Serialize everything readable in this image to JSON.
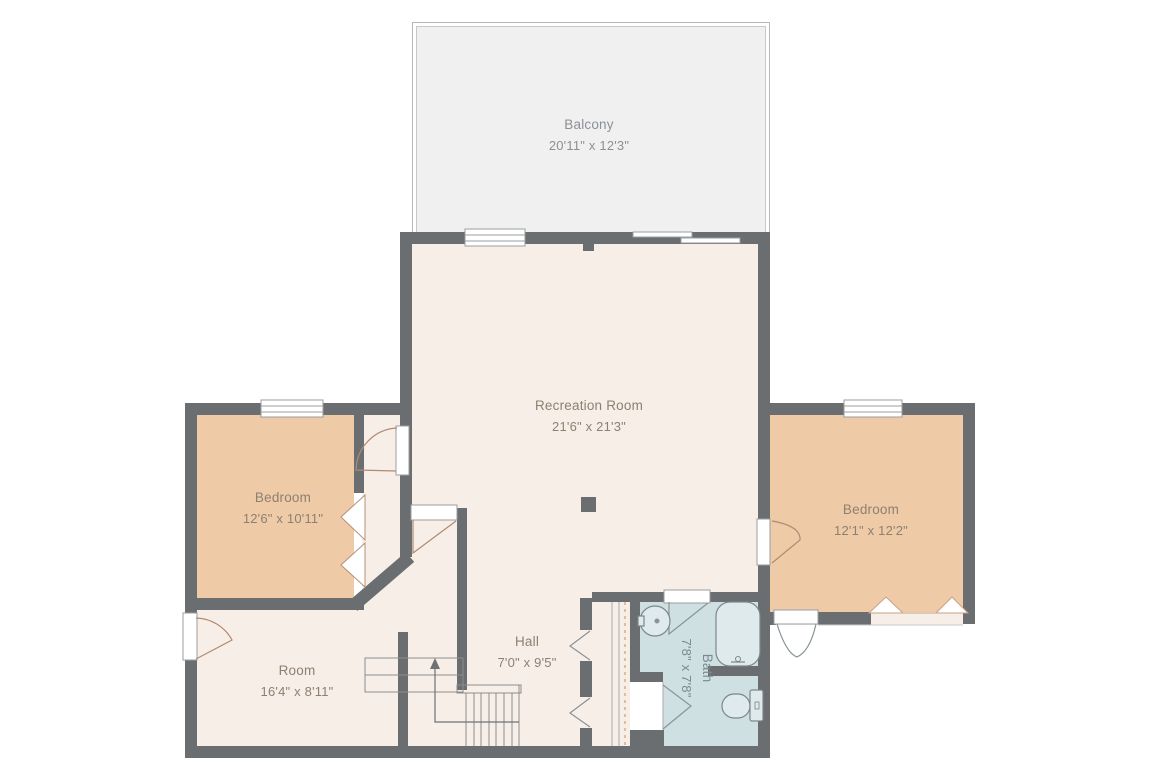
{
  "title": "Floor plan",
  "rooms": [
    {
      "name": "Balcony",
      "dims": "20'11\" x 12'3\""
    },
    {
      "name": "Recreation Room",
      "dims": "21'6\" x 21'3\""
    },
    {
      "name": "Bedroom",
      "dims": "12'6\" x 10'11\""
    },
    {
      "name": "Bedroom",
      "dims": "12'1\" x 12'2\""
    },
    {
      "name": "Room",
      "dims": "16'4\" x 8'11\""
    },
    {
      "name": "Hall",
      "dims": "7'0\" x 9'5\""
    },
    {
      "name": "Bath",
      "dims": "7'8\" x 7'8\""
    }
  ],
  "fixtures": [
    "sink",
    "bathtub",
    "toilet",
    "staircase",
    "stair-up-arrow"
  ],
  "colors": {
    "wall": "#6a6e70",
    "floor_main": "#f8eee8",
    "floor_bedroom": "#eecaa6",
    "floor_bath": "#cfe0e3",
    "balcony": "#f0f0f1",
    "label_text": "#8e8071",
    "dashed_line": "#cf9f72",
    "background": "#ffffff"
  }
}
